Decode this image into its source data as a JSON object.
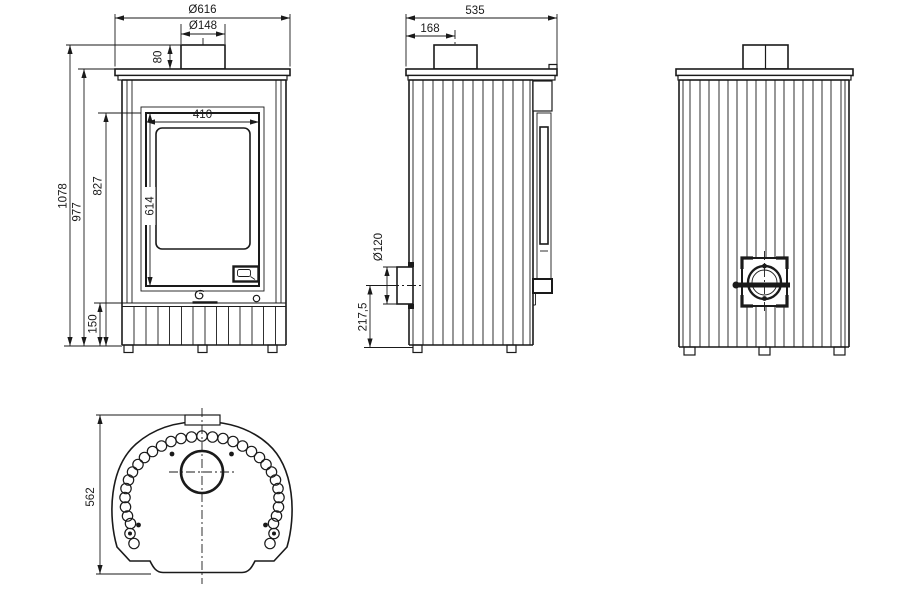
{
  "dims": {
    "front": {
      "top_plate_diameter": "Ø616",
      "flue_diameter": "Ø148",
      "collar_height": "80",
      "door_width": "410",
      "door_height": "614",
      "total_height": "1078",
      "height_to_plate": "977",
      "height_to_door_top": "827",
      "base_height": "150"
    },
    "side": {
      "depth": "535",
      "flue_center_from_back": "168",
      "air_inlet_diameter": "Ø120",
      "air_inlet_center_height": "217,5"
    },
    "top": {
      "plate_depth": "562"
    }
  }
}
